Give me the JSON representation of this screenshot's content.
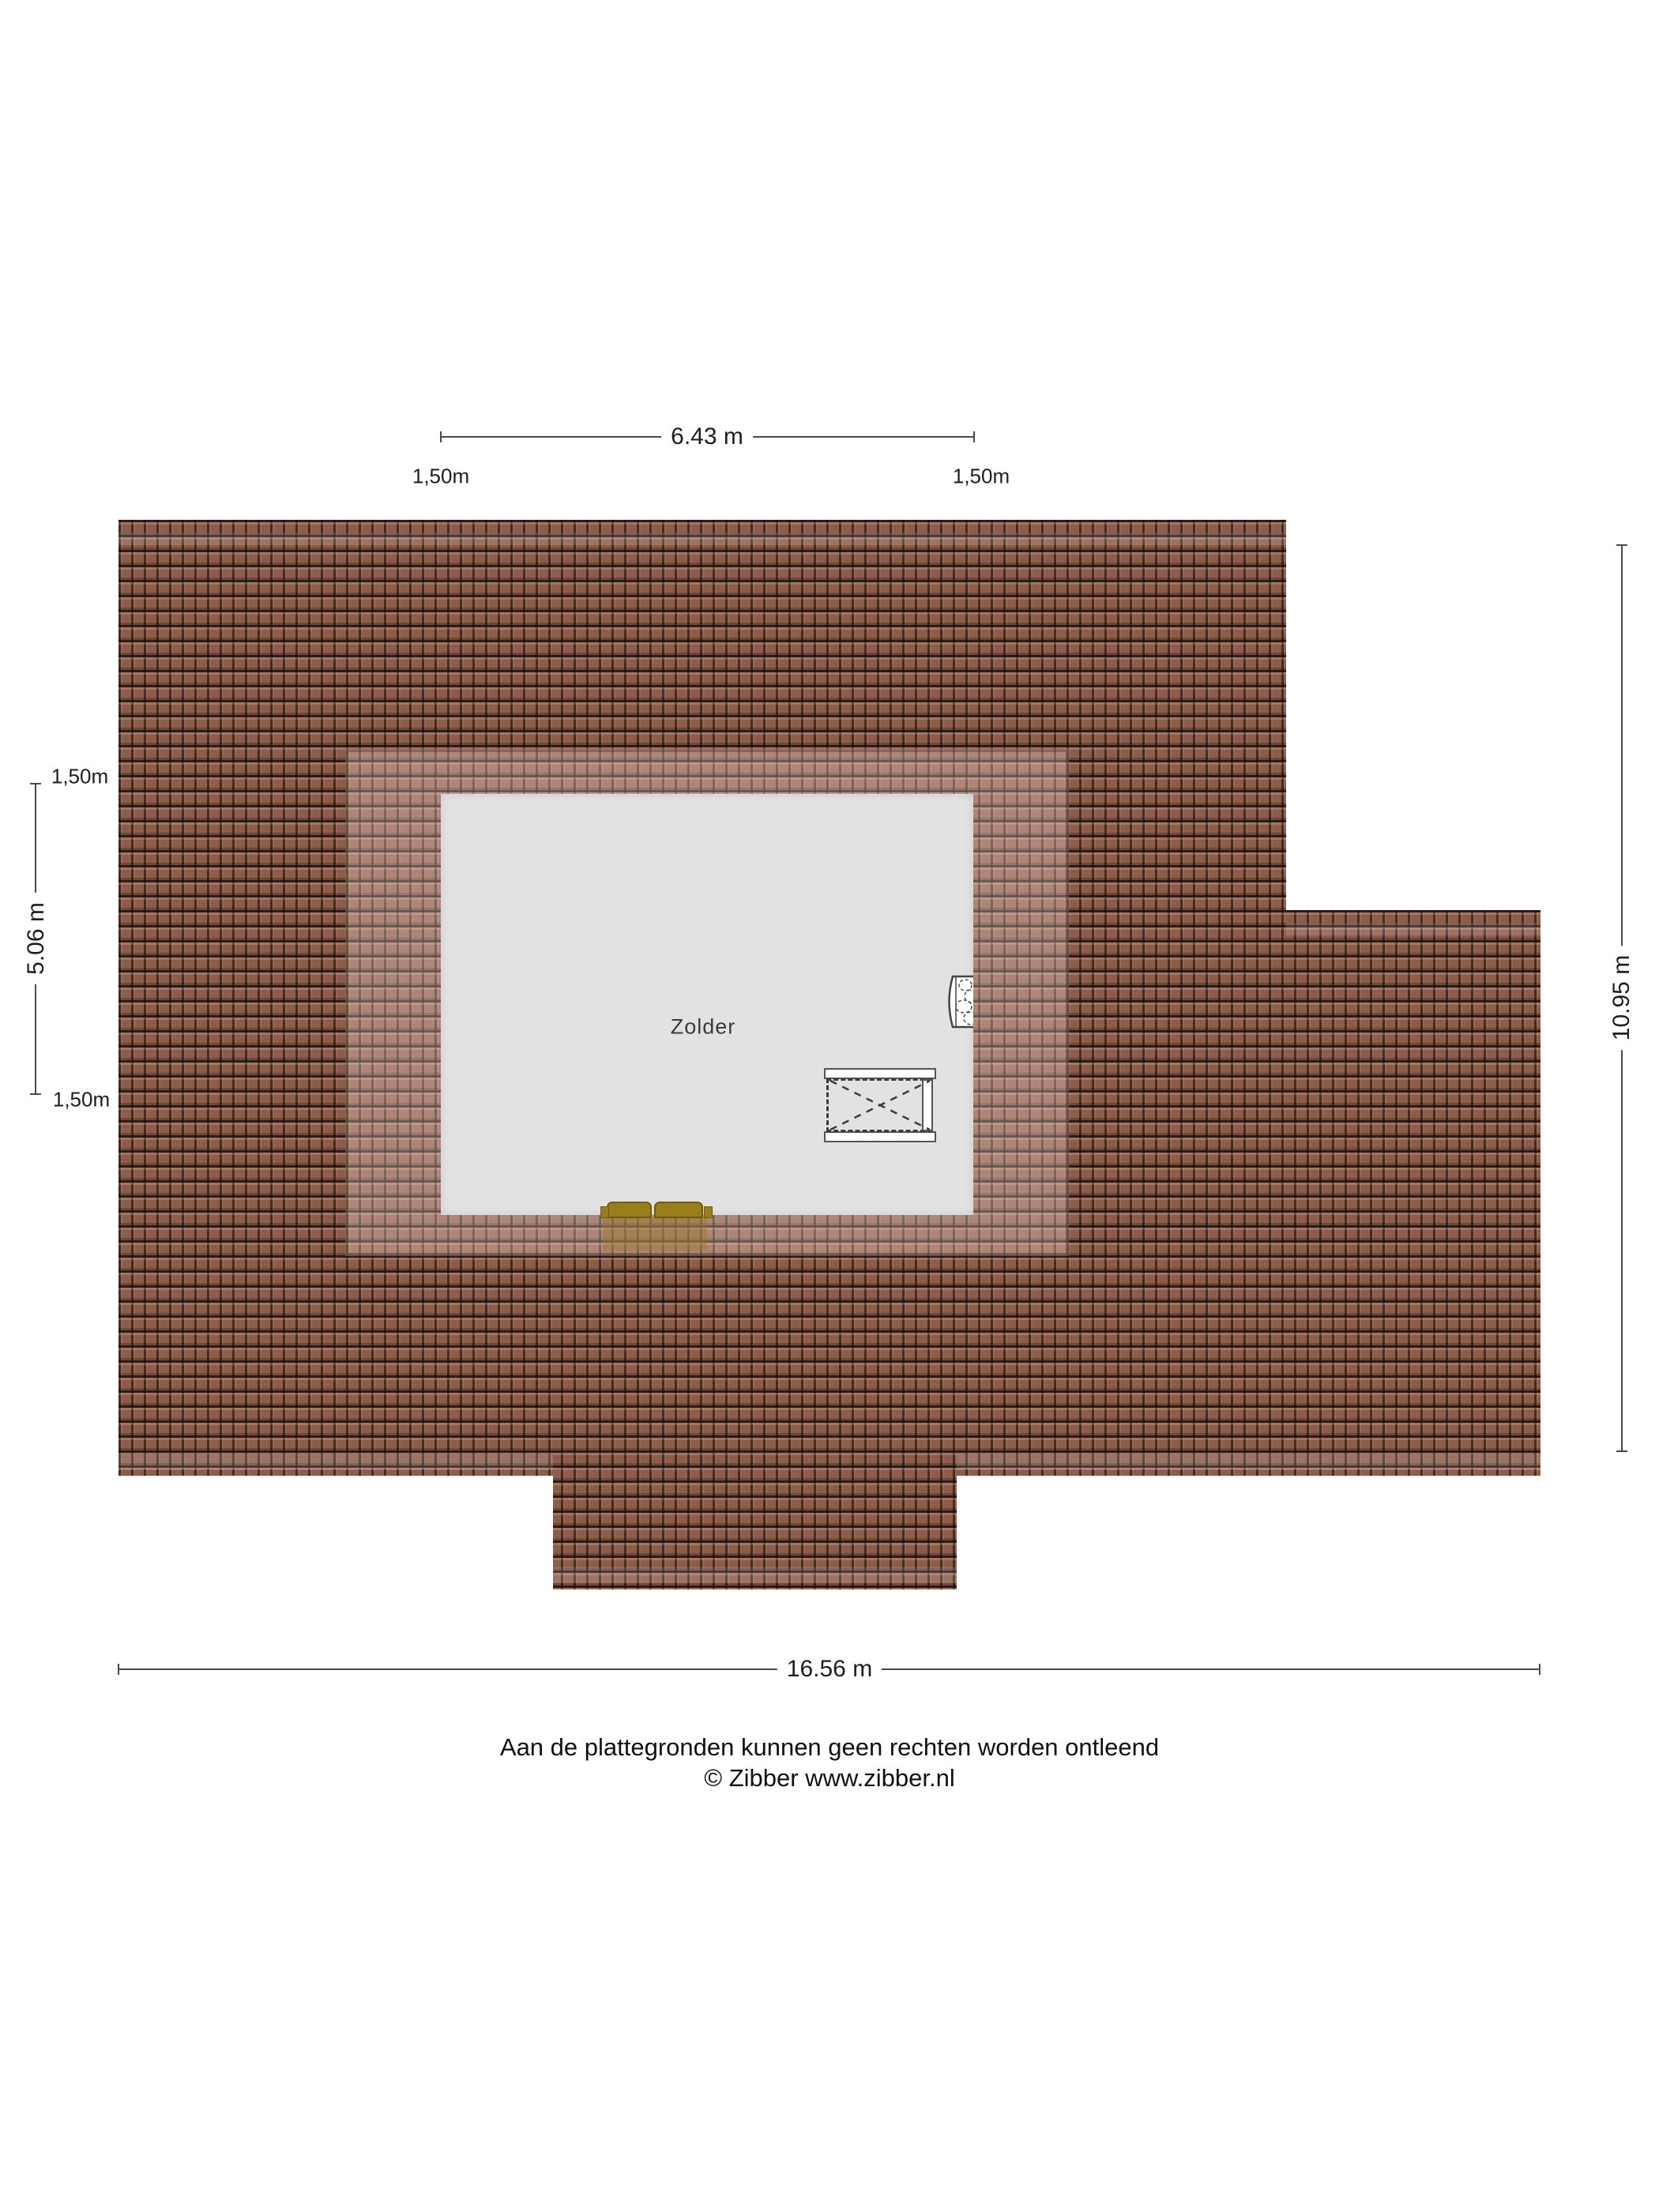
{
  "floorplan": {
    "room_label": "Zolder",
    "dimensions": {
      "top": "6.43 m",
      "top_left_offset": "1,50m",
      "top_right_offset": "1,50m",
      "left_upper_offset": "1,50m",
      "left": "5.06 m",
      "left_lower_offset": "1,50m",
      "right": "10.95 m",
      "bottom": "16.56 m"
    },
    "colors": {
      "roof_tile": "#8d5c4b",
      "roof_gap": "#2f1a12",
      "dormer_overlay": "rgba(252,232,222,0.30)",
      "room_fill": "#e2e2e2",
      "sofa_fill": "#9a7e1d",
      "sofa_edge": "#6f5a12",
      "line_color": "#4a4a4a",
      "text_color": "#1e1e1e"
    }
  },
  "footer": {
    "disclaimer": "Aan de plattegronden kunnen geen rechten worden ontleend",
    "copyright": "© Zibber www.zibber.nl"
  }
}
